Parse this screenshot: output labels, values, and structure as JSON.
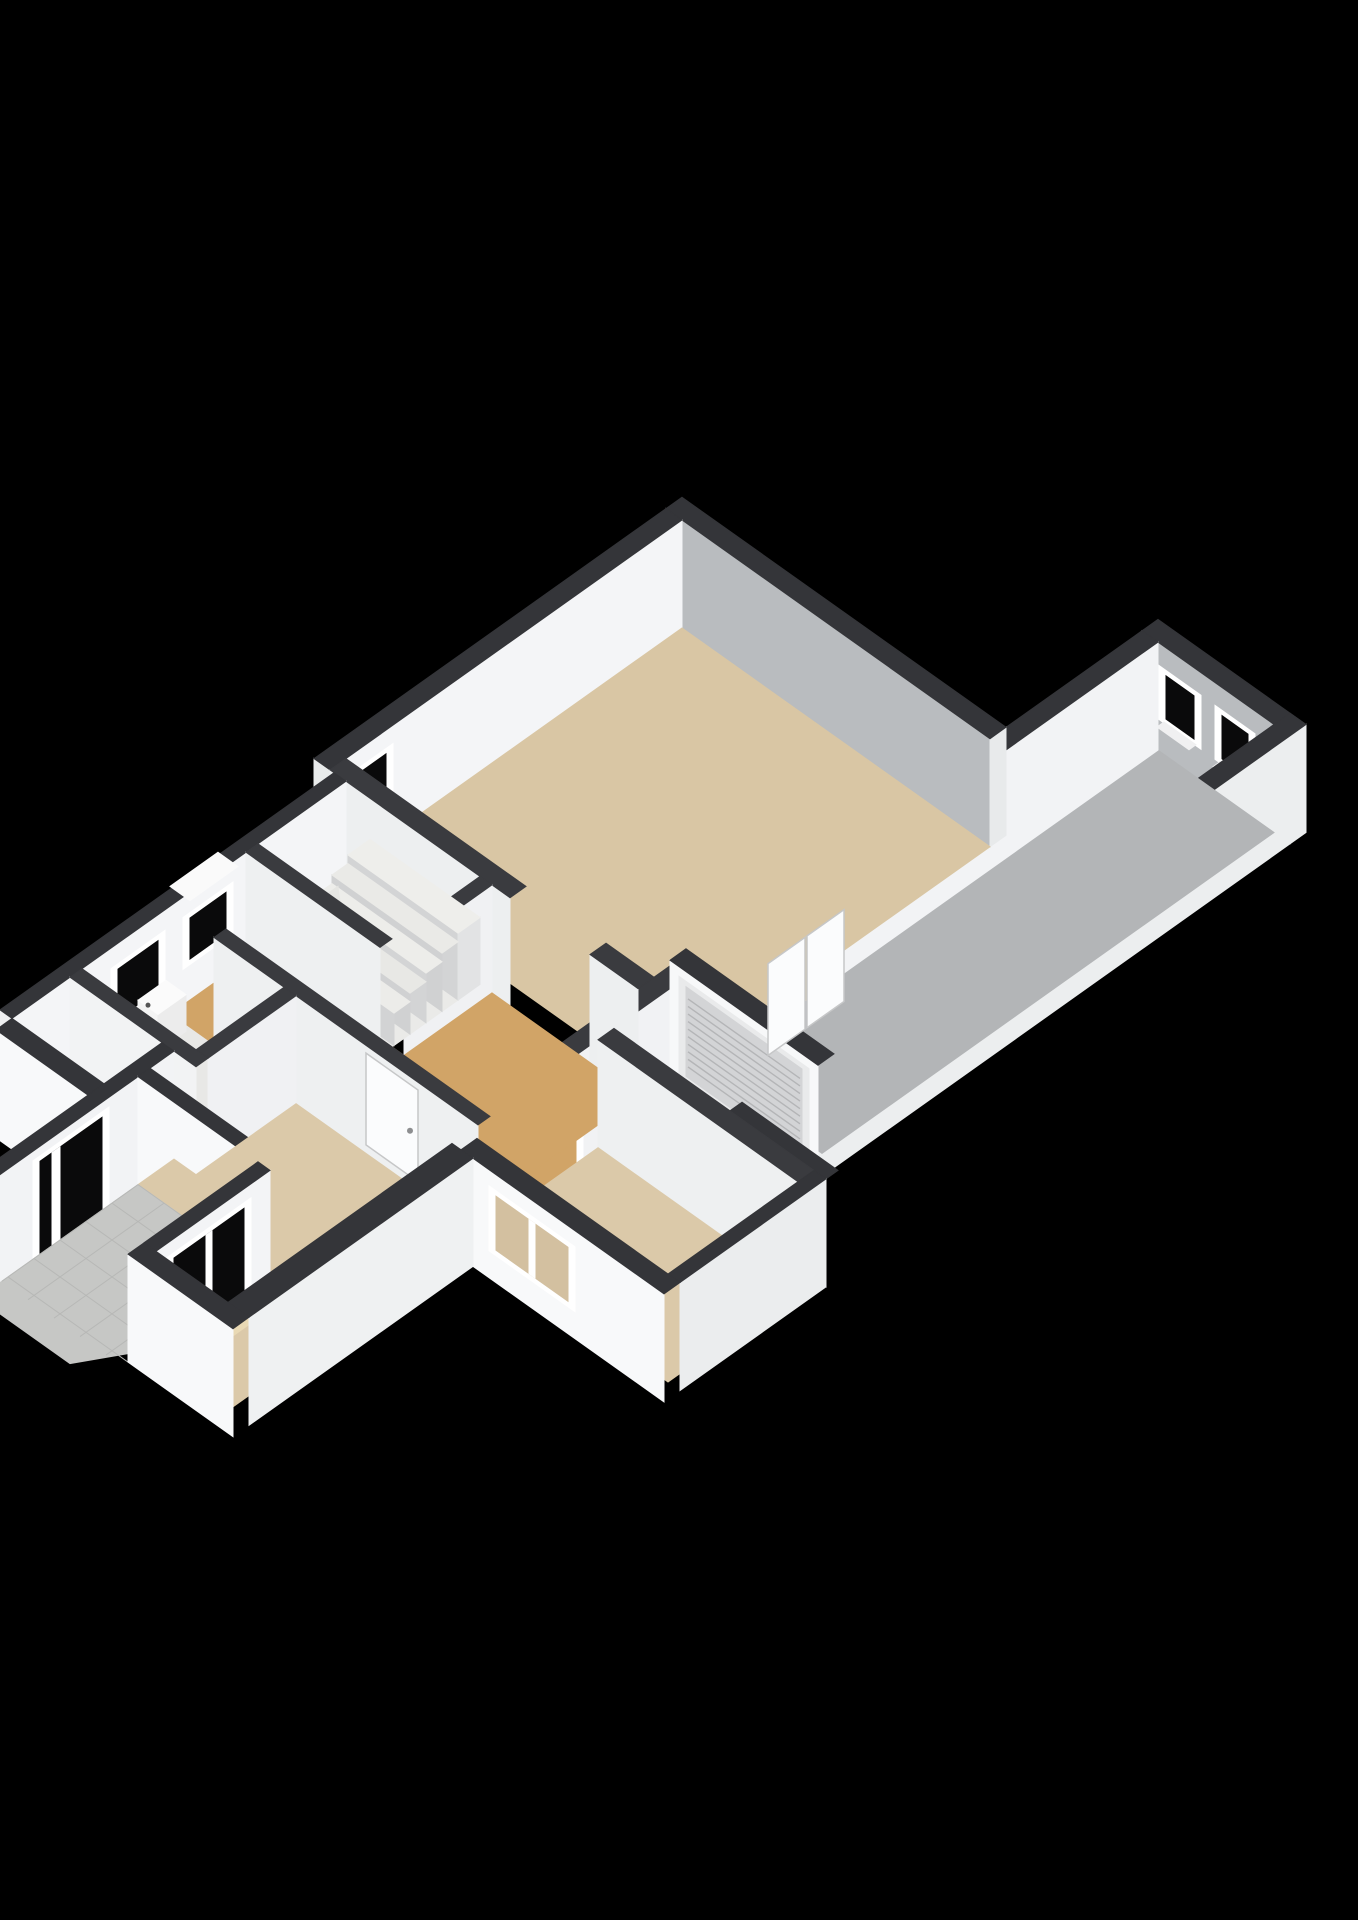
{
  "meta": {
    "description": "3D axonometric floor plan render, ground floor of a house with attached garage wing",
    "background_color": "#000000"
  },
  "palette": {
    "wall_top": "#343539",
    "wall_interior_gray": "#b9bcbf",
    "wall_interior_white": "#f3f4f6",
    "wall_exterior_white": "#f8f9fa",
    "floor_living": "#d9c6a4",
    "floor_front_rooms": "#dbc9a9",
    "floor_hall": "#d1a467",
    "floor_garage": "#b3b5b7",
    "floor_stair_room": "#eaeae8",
    "floor_toilet": "#e8e8e6",
    "porch_tiles": "#c6c7c5",
    "window_frame": "#ffffff",
    "window_glass_dark": "#0a0a0b",
    "roller_door": "#d3d4d6"
  },
  "rooms": [
    {
      "name": "living-room",
      "floor": "#d9c6a4"
    },
    {
      "name": "garage",
      "floor": "#b3b5b7"
    },
    {
      "name": "hallway",
      "floor": "#d1a467"
    },
    {
      "name": "entry",
      "floor": "#d1a467"
    },
    {
      "name": "stair-room",
      "floor": "#eaeae8"
    },
    {
      "name": "toilet",
      "floor": "#e8e8e6"
    },
    {
      "name": "front-left-room",
      "floor": "#dbc9a9"
    },
    {
      "name": "front-right-room",
      "floor": "#dbc9a9"
    },
    {
      "name": "porch",
      "floor": "#c6c7c5"
    }
  ],
  "projection": {
    "x0": 682,
    "y0": 628,
    "slope": 0.71,
    "wall_height": 108,
    "canvas": [
      1358,
      1920
    ]
  },
  "ops": [
    {
      "t": "box",
      "n": "garage-ne-wall",
      "b": [
        308,
        456,
        -168,
        -152
      ],
      "top": "#343539",
      "pv": "#b9bcbf"
    },
    {
      "t": "hV",
      "n": "garage-window-1",
      "v": -152,
      "u": [
        332,
        360
      ],
      "z": [
        0.34,
        0.74
      ],
      "f": "#ffffff",
      "g": "#0a0a0b"
    },
    {
      "t": "slab",
      "n": "garage-window-1-sill",
      "pts": [
        [
          330,
          -152
        ],
        [
          362,
          -152
        ],
        [
          362,
          -145
        ],
        [
          330,
          -145
        ]
      ],
      "z": 0.3,
      "c": "#f0f0f1"
    },
    {
      "t": "hV",
      "n": "garage-window-2",
      "v": -152,
      "u": [
        388,
        414
      ],
      "z": [
        0.34,
        0.74
      ],
      "f": "#ffffff",
      "g": "#0a0a0b"
    },
    {
      "t": "slab",
      "n": "garage-window-2-sill",
      "pts": [
        [
          386,
          -152
        ],
        [
          416,
          -152
        ],
        [
          416,
          -145
        ],
        [
          386,
          -145
        ]
      ],
      "z": 0.3,
      "c": "#f0f0f1"
    },
    {
      "t": "box",
      "n": "garage-se-wall",
      "b": [
        440,
        456,
        -168,
        380
      ],
      "top": "#343539",
      "pu": "#eceeef"
    },
    {
      "t": "floor",
      "n": "garage-floor",
      "pts": [
        [
          324,
          -152
        ],
        [
          440,
          -152
        ],
        [
          440,
          300
        ],
        [
          324,
          300
        ]
      ],
      "c": "#b3b5b7"
    },
    {
      "t": "box",
      "n": "garage-nw-wall",
      "b": [
        308,
        324,
        -152,
        316
      ],
      "top": "#343539",
      "pu": "#f2f3f5"
    },
    {
      "t": "hU",
      "n": "garage-doorway",
      "u": 324,
      "v": [
        175,
        235
      ],
      "z": [
        0,
        0.84
      ],
      "f": "#ffffff",
      "g": "#d9c6a4"
    },
    {
      "t": "box",
      "n": "wall-vent",
      "b": [
        310,
        322,
        46,
        70
      ],
      "z": [
        1,
        1.13
      ],
      "top": "#fdfdfd",
      "pu": "#e8e8e8",
      "pv": "#f2f2f2"
    },
    {
      "t": "box",
      "n": "living-ne-wall",
      "b": [
        -16,
        308,
        -16,
        0
      ],
      "top": "#343539",
      "pv": "#b9bcbf",
      "pu": "#e8eaeb"
    },
    {
      "t": "box",
      "n": "living-nw-wall",
      "b": [
        -16,
        0,
        0,
        352
      ],
      "top": "#343539",
      "pu": "#f4f5f7",
      "pv": "#e9ebeb"
    },
    {
      "t": "hU",
      "n": "living-window",
      "u": 0,
      "v": [
        296,
        340
      ],
      "z": [
        0.32,
        0.78
      ],
      "f": "#ffffff",
      "g": "#0a0a0b"
    },
    {
      "t": "floor",
      "n": "living-floor",
      "pts": [
        [
          0,
          0
        ],
        [
          308,
          0
        ],
        [
          308,
          336
        ],
        [
          0,
          336
        ]
      ],
      "c": "#d9c6a4"
    },
    {
      "t": "box",
      "n": "inner-wall-garage-side-a",
      "b": [
        308,
        324,
        316,
        430
      ],
      "top": "#3a3b3f",
      "pu": "#f1f2f4"
    },
    {
      "t": "box",
      "n": "inner-wall-garage-side-b",
      "b": [
        308,
        324,
        488,
        516
      ],
      "top": "#3a3b3f",
      "pu": "#f1f2f4"
    },
    {
      "t": "hU",
      "n": "hall-to-room-doorway",
      "u": 324,
      "v": [
        430,
        488
      ],
      "z": [
        0,
        0.88
      ],
      "f": "#ffffff",
      "g": "#d1a467"
    },
    {
      "t": "box",
      "n": "garage-sw-wall",
      "b": [
        304,
        452,
        300,
        316
      ],
      "top": "#343539",
      "pv": "#f7f8f9"
    },
    {
      "t": "hV",
      "n": "garage-roller-door",
      "v": 316,
      "u": [
        320,
        436
      ],
      "z": [
        0.03,
        0.86
      ],
      "f": "#e9eaeb",
      "g": "#d3d4d6"
    },
    {
      "t": "slatsV",
      "n": "roller-door-slats",
      "v": 316,
      "u": [
        322,
        434
      ],
      "z": [
        0.06,
        0.83
      ],
      "num": 10,
      "c": "#b4b5b7"
    },
    {
      "t": "dotV",
      "n": "roller-door-handle",
      "v": 316,
      "u": 378,
      "z": 0.12,
      "r": 3.5,
      "c": "#8d8e90"
    },
    {
      "t": "box",
      "n": "side-step-wall",
      "b": [
        440,
        536,
        380,
        392
      ],
      "top": "#343539",
      "pv": "#f6f7f8"
    },
    {
      "t": "box",
      "n": "living-sw-wall-a",
      "b": [
        0,
        180,
        336,
        352
      ],
      "top": "#3a3b3f",
      "pv": "#edeff0"
    },
    {
      "t": "box",
      "n": "living-sw-wall-b",
      "b": [
        260,
        308,
        336,
        352
      ],
      "top": "#3a3b3f",
      "pv": "#edeff0"
    },
    {
      "t": "leafU",
      "n": "living-double-door-left",
      "u": 344,
      "v": [
        182,
        219
      ],
      "z": [
        0,
        0.85
      ],
      "c": "#fbfcfd"
    },
    {
      "t": "leafU",
      "n": "living-double-door-right",
      "u": 344,
      "v": [
        221,
        258
      ],
      "z": [
        0,
        0.85
      ],
      "c": "#fbfcfd"
    },
    {
      "t": "box",
      "n": "stair-se-wall",
      "b": [
        150,
        162,
        352,
        440
      ],
      "top": "#3a3b3f",
      "pu": "#f0f1f3"
    },
    {
      "t": "box",
      "n": "nw-facade-lower",
      "b": [
        4,
        16,
        352,
        686
      ],
      "top": "#343539",
      "pu": "#f4f5f7",
      "pv": "#eff0f1"
    },
    {
      "t": "hU",
      "n": "stair-window",
      "u": 16,
      "v": [
        472,
        508
      ],
      "z": [
        0.38,
        0.76
      ],
      "f": "#ffffff",
      "g": "#0a0a0b"
    },
    {
      "t": "slab",
      "n": "stair-window-sill",
      "pts": [
        [
          2,
          466
        ],
        [
          22,
          466
        ],
        [
          22,
          514
        ],
        [
          2,
          514
        ]
      ],
      "z": 1.0,
      "c": "#fafafa"
    },
    {
      "t": "hU",
      "n": "toilet-window",
      "u": 16,
      "v": [
        540,
        580
      ],
      "z": [
        0.3,
        0.76
      ],
      "f": "#ffffff",
      "g": "#0a0a0b"
    },
    {
      "t": "floor",
      "n": "stair-room-floor",
      "pts": [
        [
          16,
          352
        ],
        [
          150,
          352
        ],
        [
          150,
          440
        ],
        [
          16,
          440
        ]
      ],
      "c": "#eaeae8"
    },
    {
      "t": "box",
      "n": "stair-landing",
      "b": [
        40,
        150,
        352,
        374
      ],
      "z": [
        0,
        0.62
      ],
      "top": "#eeeeeb",
      "pv": "#d3d4d5",
      "pu": "#e2e3e4"
    },
    {
      "t": "box",
      "n": "stair-step-2",
      "b": [
        40,
        150,
        374,
        390
      ],
      "z": [
        0,
        0.54
      ],
      "top": "#eaeae7",
      "pv": "#d0d1d2"
    },
    {
      "t": "box",
      "n": "stair-step-3",
      "b": [
        40,
        150,
        390,
        406
      ],
      "z": [
        0,
        0.46
      ],
      "top": "#ededea",
      "pv": "#d3d4d5"
    },
    {
      "t": "box",
      "n": "stair-step-4",
      "b": [
        40,
        150,
        406,
        422
      ],
      "z": [
        0,
        0.38
      ],
      "top": "#e8e8e5",
      "pv": "#d0d1d2"
    },
    {
      "t": "box",
      "n": "stair-step-5",
      "b": [
        40,
        150,
        422,
        438
      ],
      "z": [
        0,
        0.3
      ],
      "top": "#ecece9",
      "pv": "#d2d3d4"
    },
    {
      "t": "slab",
      "n": "stair-winder-1",
      "pts": [
        [
          16,
          404
        ],
        [
          40,
          420
        ],
        [
          40,
          438
        ],
        [
          16,
          438
        ]
      ],
      "z": 0.22,
      "c": "#e7e7e4"
    },
    {
      "t": "face",
      "n": "stair-winder-1-riser",
      "pts": [
        [
          16,
          438,
          0
        ],
        [
          40,
          438,
          0
        ],
        [
          40,
          438,
          0.22
        ],
        [
          16,
          438,
          0.22
        ]
      ],
      "c": "#cfd0d1"
    },
    {
      "t": "slab",
      "n": "stair-winder-2",
      "pts": [
        [
          16,
          380
        ],
        [
          40,
          404
        ],
        [
          40,
          420
        ],
        [
          16,
          404
        ]
      ],
      "z": 0.15,
      "c": "#eaeae7"
    },
    {
      "t": "slab",
      "n": "stair-winder-3",
      "pts": [
        [
          16,
          360
        ],
        [
          40,
          380
        ],
        [
          40,
          404
        ],
        [
          16,
          380
        ]
      ],
      "z": 0.08,
      "c": "#e5e5e2"
    },
    {
      "t": "box",
      "n": "stair-hall-wall",
      "b": [
        16,
        150,
        440,
        452
      ],
      "top": "#3a3b3f",
      "pv": "#eef0f1"
    },
    {
      "t": "floor",
      "n": "hall-floor",
      "pts": [
        [
          162,
          352
        ],
        [
          308,
          352
        ],
        [
          308,
          516
        ],
        [
          60,
          516
        ],
        [
          60,
          528
        ],
        [
          16,
          528
        ],
        [
          16,
          452
        ],
        [
          150,
          452
        ],
        [
          150,
          440
        ],
        [
          162,
          440
        ]
      ],
      "c": "#d1a467"
    },
    {
      "t": "box",
      "n": "hall-sw-wall",
      "b": [
        60,
        324,
        516,
        528
      ],
      "top": "#3a3b3f",
      "pv": "#eef0f1"
    },
    {
      "t": "leafV",
      "n": "hall-door-leaf",
      "v": 522,
      "u": [
        206,
        258
      ],
      "z": [
        0,
        0.85
      ],
      "c": "#fbfcfd",
      "handle": [
        250,
        0.42
      ]
    },
    {
      "t": "floor",
      "n": "toilet-floor",
      "pts": [
        [
          16,
          528
        ],
        [
          130,
          528
        ],
        [
          130,
          616
        ],
        [
          16,
          616
        ]
      ],
      "c": "#e8e8e6"
    },
    {
      "t": "box",
      "n": "toilet-sink",
      "b": [
        16,
        36,
        532,
        560
      ],
      "z": [
        0,
        0.34
      ],
      "top": "#fbfbfb",
      "pu": "#ececec",
      "pv": "#f4f4f4"
    },
    {
      "t": "dotV",
      "n": "toilet-tap",
      "v": 560,
      "u": 26,
      "z": 0.36,
      "r": 2.5,
      "c": "#555"
    },
    {
      "t": "box",
      "n": "toilet-e-wall",
      "b": [
        130,
        142,
        528,
        616
      ],
      "top": "#3a3b3f",
      "pu": "#f0f1f3"
    },
    {
      "t": "box",
      "n": "toilet-s-wall",
      "b": [
        16,
        142,
        616,
        628
      ],
      "top": "#3a3b3f",
      "pv": "#f2f3f4"
    },
    {
      "t": "floor",
      "n": "entry-floor",
      "pts": [
        [
          16,
          628
        ],
        [
          108,
          628
        ],
        [
          108,
          686
        ],
        [
          16,
          686
        ]
      ],
      "c": "#d1a467"
    },
    {
      "t": "box",
      "n": "entry-sw-facade",
      "b": [
        16,
        108,
        686,
        702
      ],
      "top": "#343539",
      "pv": "#f8f9fa"
    },
    {
      "t": "box",
      "n": "porch-w-wall",
      "b": [
        108,
        120,
        628,
        806
      ],
      "top": "#343539",
      "pu": "#f2f3f5",
      "pv": "#f6f7f8"
    },
    {
      "t": "hU",
      "n": "front-door",
      "u": 120,
      "v": [
        700,
        762
      ],
      "z": [
        0,
        0.86
      ],
      "f": "#ffffff",
      "g": "#0a0a0b",
      "m": [
        742,
        750
      ]
    },
    {
      "t": "box",
      "n": "porch-n-wall",
      "b": [
        120,
        252,
        652,
        664
      ],
      "top": "#343539",
      "pv": "#f8f9fa"
    },
    {
      "t": "floor",
      "n": "front-left-room-floor",
      "pts": [
        [
          142,
          528
        ],
        [
          324,
          528
        ],
        [
          324,
          778
        ],
        [
          252,
          778
        ],
        [
          252,
          664
        ],
        [
          120,
          664
        ],
        [
          120,
          628
        ],
        [
          142,
          628
        ]
      ],
      "c": "#dbc9a9"
    },
    {
      "t": "slab",
      "n": "window-light-patch",
      "pts": [
        [
          252,
          690
        ],
        [
          274,
          696
        ],
        [
          274,
          754
        ],
        [
          252,
          760
        ]
      ],
      "z": 0,
      "c": "#e9d9b4"
    },
    {
      "t": "floor",
      "n": "porch-tiles",
      "pts": [
        [
          120,
          664
        ],
        [
          240,
          664
        ],
        [
          240,
          778
        ],
        [
          212,
          824
        ],
        [
          120,
          824
        ]
      ],
      "c": "#c6c7c5"
    },
    {
      "t": "grid",
      "n": "porch-tile-grid",
      "b": [
        120,
        240,
        664,
        800
      ],
      "step": 26,
      "c": "#b7b8b6"
    },
    {
      "t": "box",
      "n": "porch-e-wall",
      "b": [
        240,
        252,
        664,
        778
      ],
      "top": "#343539",
      "pu": "#f3f4f6",
      "pv": "#f6f7f8"
    },
    {
      "t": "hU",
      "n": "front-big-window",
      "u": 252,
      "v": [
        690,
        760
      ],
      "z": [
        0.06,
        0.82
      ],
      "f": "#ffffff",
      "g": "#0a0a0b",
      "m": [
        722,
        728
      ]
    },
    {
      "t": "box",
      "n": "front-right-room-n-wall",
      "b": [
        324,
        524,
        392,
        408
      ],
      "top": "#3a3b3f",
      "pv": "#eef0f1"
    },
    {
      "t": "floor",
      "n": "front-right-room-floor",
      "pts": [
        [
          324,
          408
        ],
        [
          524,
          408
        ],
        [
          524,
          538
        ],
        [
          324,
          538
        ]
      ],
      "c": "#dbc9a9"
    },
    {
      "t": "box",
      "n": "front-right-se-wall",
      "b": [
        524,
        536,
        392,
        538
      ],
      "top": "#343539",
      "pu": "#ebedee"
    },
    {
      "t": "box",
      "n": "front-right-facade",
      "b": [
        333,
        536,
        538,
        554
      ],
      "top": "#343539",
      "pv": "#f8f9fa"
    },
    {
      "t": "hV",
      "n": "front-right-window",
      "v": 554,
      "u": [
        368,
        440
      ],
      "z": [
        0.3,
        0.8
      ],
      "f": "#ffffff",
      "g": "#d3c0a0",
      "m": [
        401,
        407
      ]
    },
    {
      "t": "box",
      "n": "front-left-se-wall",
      "b": [
        324,
        345,
        554,
        778
      ],
      "top": "#343539",
      "pu": "#eff1f2"
    },
    {
      "t": "box",
      "n": "front-left-facade",
      "b": [
        240,
        345,
        778,
        794
      ],
      "top": "#343539",
      "pv": "#f8f9fa"
    }
  ]
}
